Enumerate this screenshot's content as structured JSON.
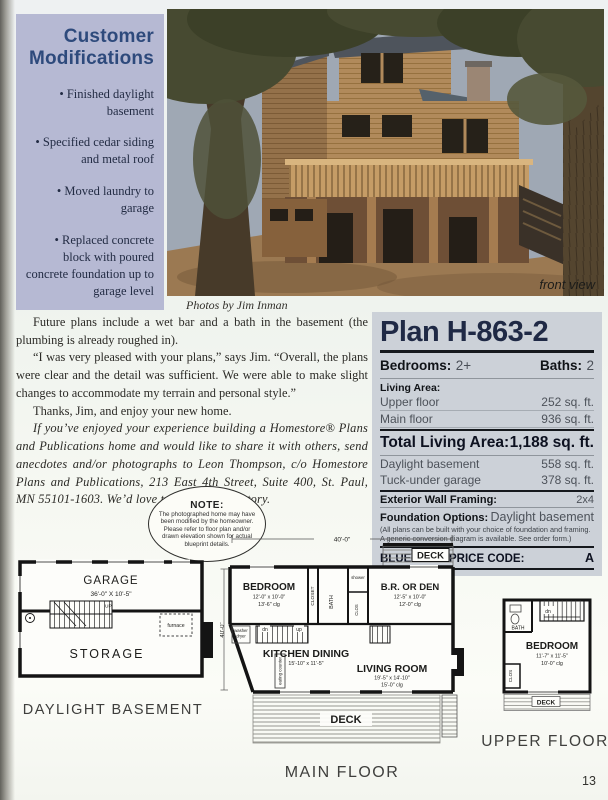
{
  "page": {
    "number": "13"
  },
  "colors": {
    "sidebar_bg": "#b6b9d3",
    "sidebar_title": "#2e4a7c",
    "panel_bg": "#ccd1d8",
    "panel_title": "#1f2945"
  },
  "sidebar_box": {
    "title": "Customer Modifications",
    "bullets": [
      "• Finished daylight basement",
      "• Specified cedar siding and metal roof",
      "• Moved laundry to garage",
      "• Replaced concrete block with poured concrete foundation up to garage level"
    ]
  },
  "photo": {
    "caption": "Photos by Jim Inman",
    "label": "front view"
  },
  "article": {
    "p1": "Future plans include a wet bar and a bath in the basement (the plumbing is already roughed in).",
    "p2": "“I was very pleased with your plans,” says Jim. “Overall, the plans were clear and the detail was sufficient. We were able to make slight changes to accommodate my terrain and personal style.”",
    "p3": "Thanks, Jim, and enjoy your new home.",
    "p4": "If you’ve enjoyed your experience building a Homestore® Plans and Publications home and would like to share it with others, send anecdotes and/or photographs to Leon Thompson, c/o Homestore Plans and Publications, 213 East 4th Street, Suite 400, St. Paul, MN 55101-1603. We’d love to publish your story."
  },
  "note": {
    "title": "NOTE:",
    "text": "The photographed home may have been modified by the homeowner. Please refer to floor plan and/or drawn elevation shown for actual blueprint details."
  },
  "specs": {
    "plan_title": "Plan H-863-2",
    "bedrooms_label": "Bedrooms:",
    "bedrooms_value": "2+",
    "baths_label": "Baths:",
    "baths_value": "2",
    "living_area_label": "Living Area:",
    "rows": [
      {
        "label": "Upper floor",
        "value": "252 sq. ft."
      },
      {
        "label": "Main floor",
        "value": "936 sq. ft."
      }
    ],
    "total_label": "Total Living Area:",
    "total_value": "1,188 sq. ft.",
    "extra_rows": [
      {
        "label": "Daylight basement",
        "value": "558 sq. ft."
      },
      {
        "label": "Tuck-under garage",
        "value": "378 sq. ft."
      }
    ],
    "framing_label": "Exterior Wall Framing:",
    "framing_value": "2x4",
    "foundation_label": "Foundation Options:",
    "foundation_value": "Daylight basement",
    "fine_print": "(All plans can be built with your choice of foundation and framing. A generic conversion diagram is available. See order form.)",
    "price_code_label": "BLUEPRINT PRICE CODE:",
    "price_code_value": "A"
  },
  "plans": {
    "basement": {
      "label": "DAYLIGHT BASEMENT",
      "garage": "GARAGE",
      "garage_dim": "36'-0\" X 10'-5\"",
      "storage": "STORAGE",
      "furnace": "furnace",
      "up": "UP"
    },
    "main": {
      "label": "MAIN FLOOR",
      "dim_top": "40'-0\"",
      "dim_left": "40'-0\"",
      "deck_top": "DECK",
      "deck_bottom": "DECK",
      "bedroom": "BEDROOM",
      "bedroom_dim": "12'-0\" x 10'-0\"",
      "bedroom_clg": "13'-6\" clg",
      "closet": "CLOSET",
      "bath": "BATH",
      "shower": "shower",
      "clos": "CLOS",
      "brden": "B.R. OR DEN",
      "brden_dim": "12'-5\" x 10'-0\"",
      "brden_clg": "12'-0\" clg",
      "washer": "washer",
      "dryer": "dryer",
      "dn": "dn",
      "up": "up",
      "kitchen": "KITCHEN DINING",
      "kitchen_dim": "15'-10\" x 11'-5\"",
      "living": "LIVING ROOM",
      "living_dim": "19'-5\" x 14'-10\"",
      "living_clg": "15'-0\" clg",
      "eating": "eating counter"
    },
    "upper": {
      "label": "UPPER FLOOR",
      "bath": "BATH",
      "clos": "CLOS",
      "dn": "dn",
      "bedroom": "BEDROOM",
      "bedroom_dim": "11'-7\" x 11'-5\"",
      "bedroom_clg": "10'-0\" clg",
      "deck": "DECK"
    }
  }
}
